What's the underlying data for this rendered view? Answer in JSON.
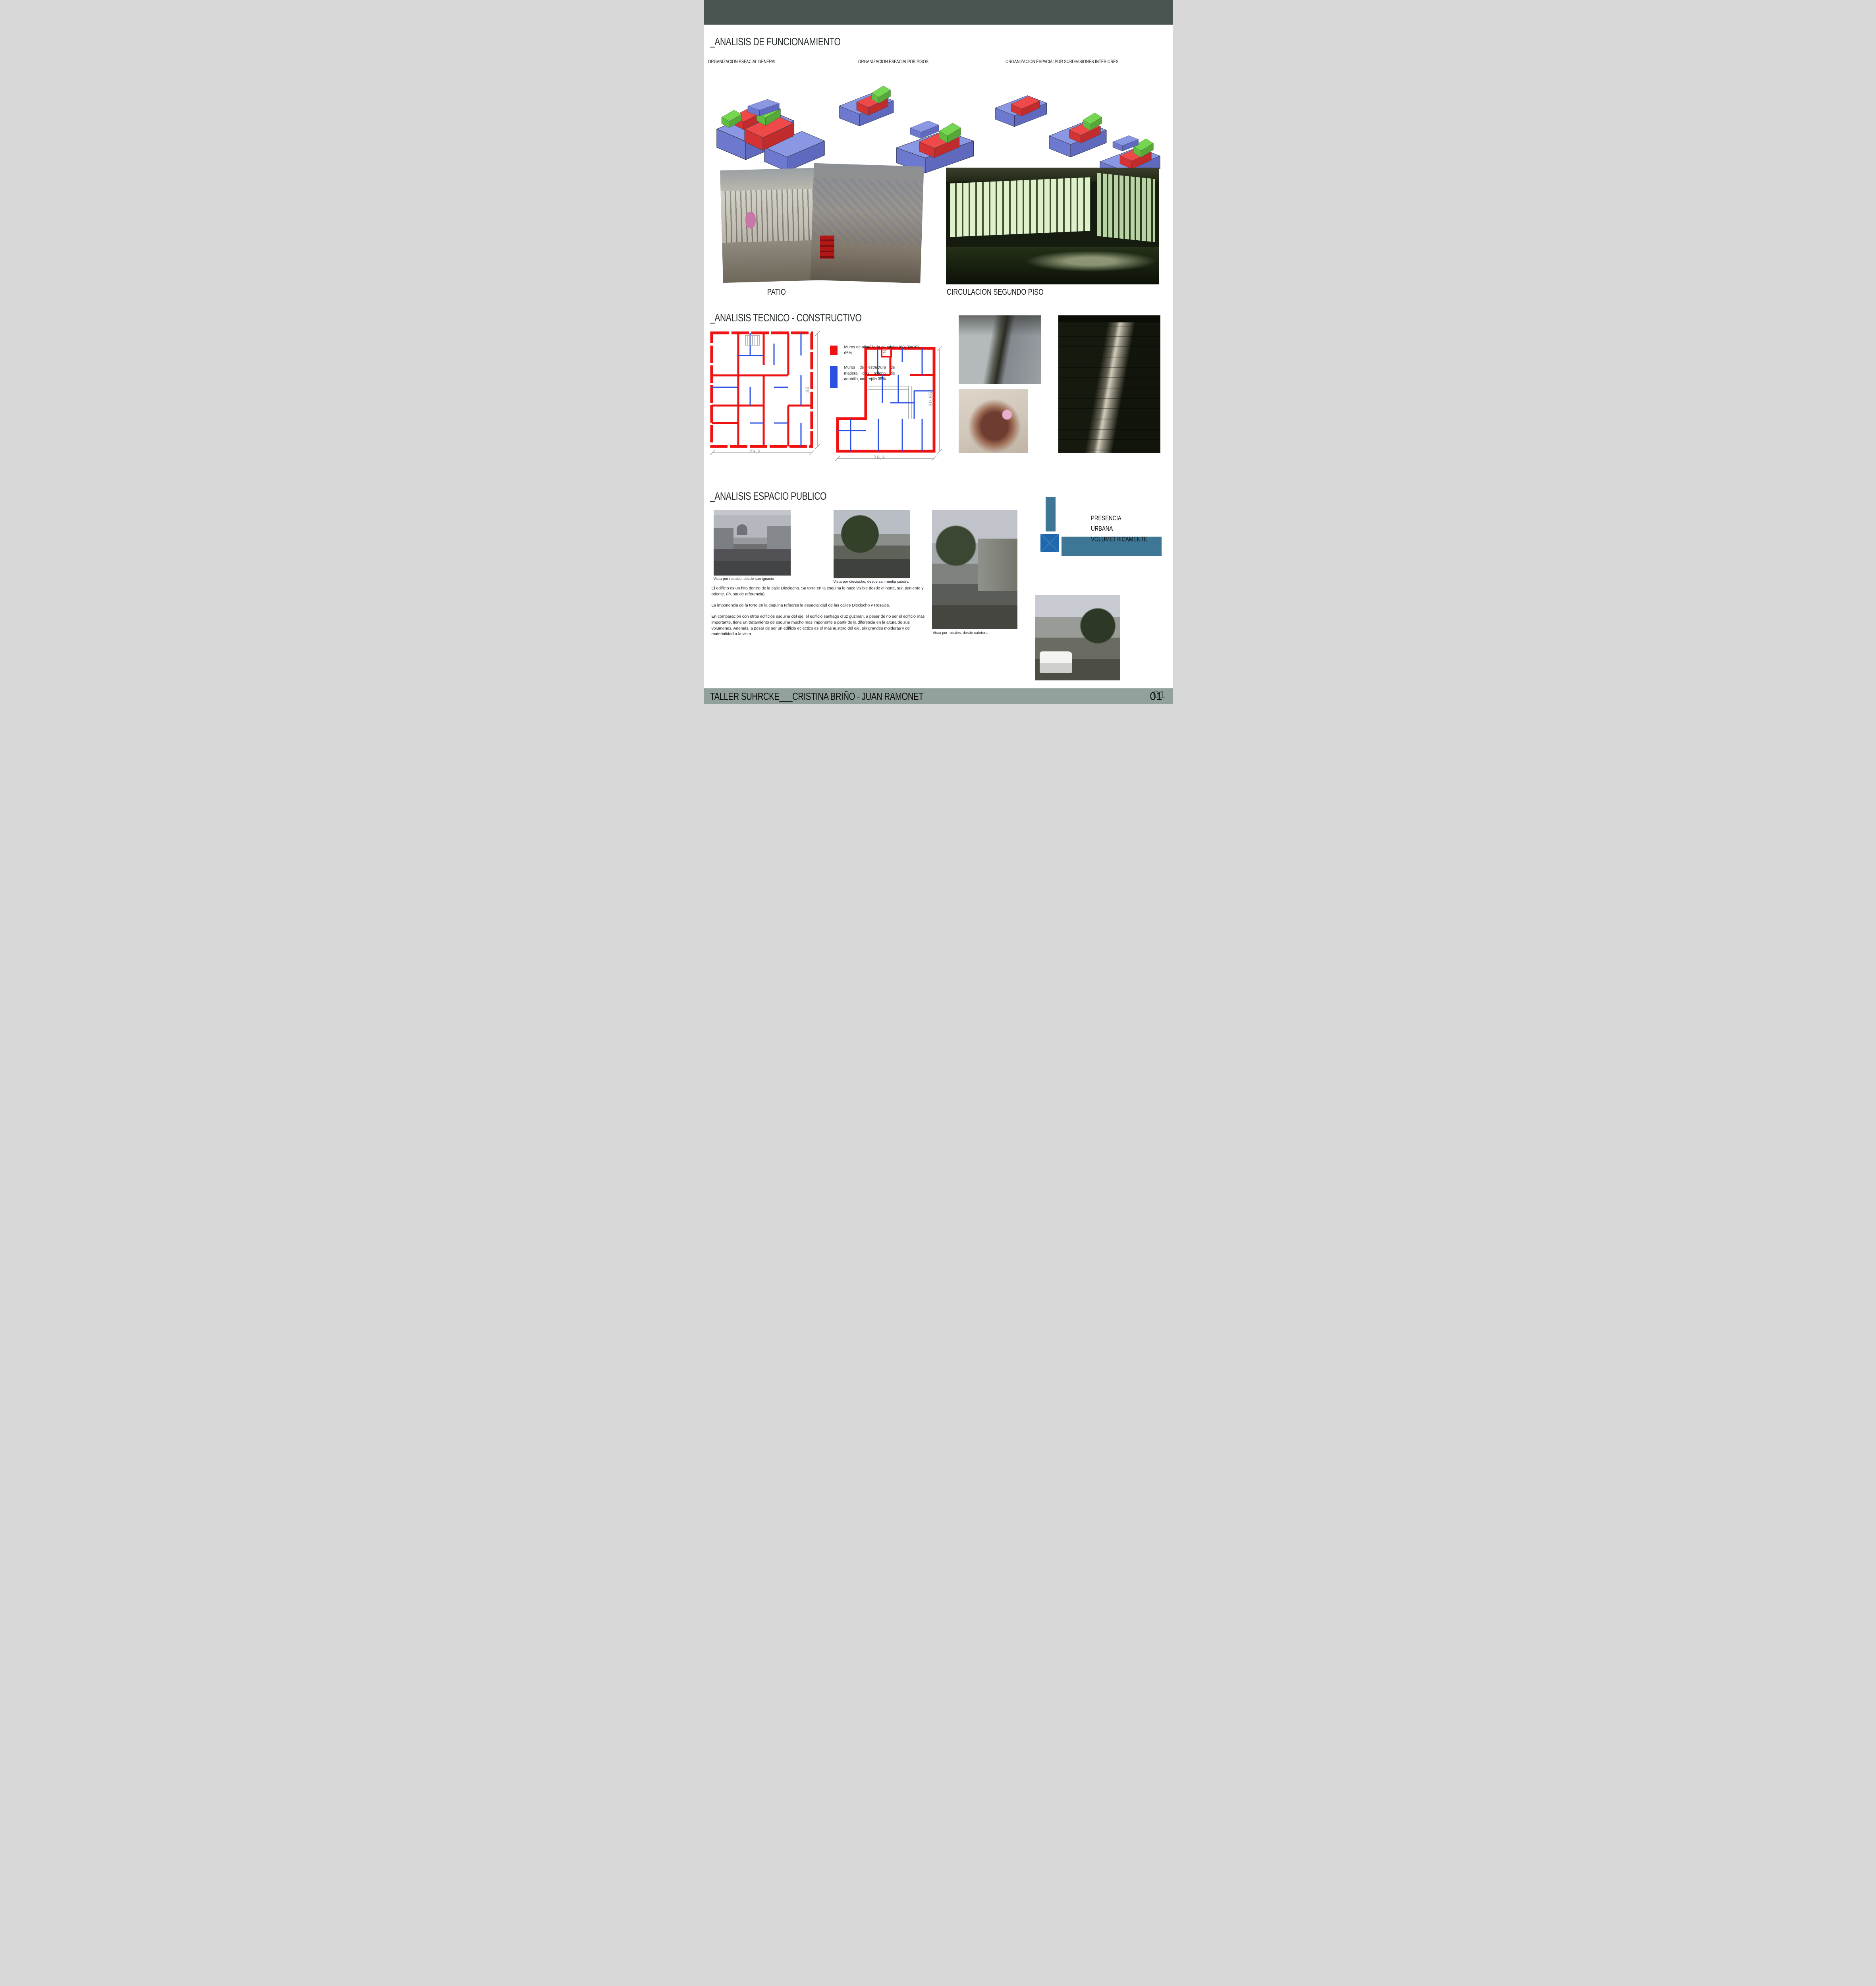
{
  "sections": {
    "funcionamiento": {
      "title": "_ANALISIS DE FUNCIONAMIENTO",
      "diagrams": [
        {
          "label": "ORGANIZACION ESPACIAL GENERAL"
        },
        {
          "label": "ORGANIZACION ESPACIALPOR PISOS"
        },
        {
          "label": "ORGANIZACION ESPACIALPOR SUBDIVISIONES INTERIORES"
        }
      ],
      "photos": [
        {
          "caption": "PATIO"
        },
        {
          "caption": "CIRCULACION SEGUNDO PISO"
        }
      ]
    },
    "tecnico": {
      "title": "_ANALISIS TECNICO - CONSTRUCTIVO",
      "legend": [
        {
          "color": "#ee1212",
          "label": "Muros de albañilería en adobe (60x30x10) 65%"
        },
        {
          "color": "#2b4fe3",
          "label": "Muros de estructura de madera con relleno de adobillo, con rejilla 35%"
        }
      ],
      "plans": [
        {
          "height_dim": "36",
          "width_dim": "29,3"
        },
        {
          "height_dim": "30,85",
          "width_dim": "29,3",
          "annotation": "27"
        }
      ]
    },
    "publico": {
      "title": "_ANALISIS ESPACIO PUBLICO",
      "photos": [
        {
          "caption": "Vista por rosales, desde san ignacio"
        },
        {
          "caption": "Vista por dieciocho, desde san media cuadra"
        },
        {
          "caption": "Vista por rosales, desde caletera."
        },
        {
          "caption": ""
        }
      ],
      "callout": {
        "lines": [
          "PRESENCIA",
          "URBANA",
          "VOLUMETRICAMENTE"
        ]
      },
      "paragraphs": [
        "El edificio es un hito dentro de la calle Dieciocho. Su torre en la esquina lo hace visible desde el norte, sur, poniente y oriente. (Punto de referencia).",
        "La imponencia de la torre en la esquina refuerza la espacialidad de las calles Dieciocho y Rosales.",
        "En comparación con otros edificios esquina del eje, el edificio santiago cruz guzman, a pesar de no ser el edificio mas importante, tiene un tratamiento de esquina mucho mas imponente a partir de la diferencia en la altura de sus volumenes. Además, a pesar de ser un edificio ecléctico es el más austero del eje, sin grandes molduras y de materialidad a la vista."
      ]
    }
  },
  "footer": {
    "title": "TALLER SUHRCKE___CRISTINA BRIÑO - JUAN RAMONET",
    "page_number": "01"
  },
  "colors": {
    "top_bar": "#4a5450",
    "bottom_bar": "#92a19b",
    "legend_red": "#ee1212",
    "legend_blue": "#2b4fe3",
    "volume_blue": "#6272d8",
    "volume_red": "#e01818",
    "volume_green": "#52c228",
    "callout_teal": "#3d7795",
    "callout_blue": "#1e68b0"
  }
}
